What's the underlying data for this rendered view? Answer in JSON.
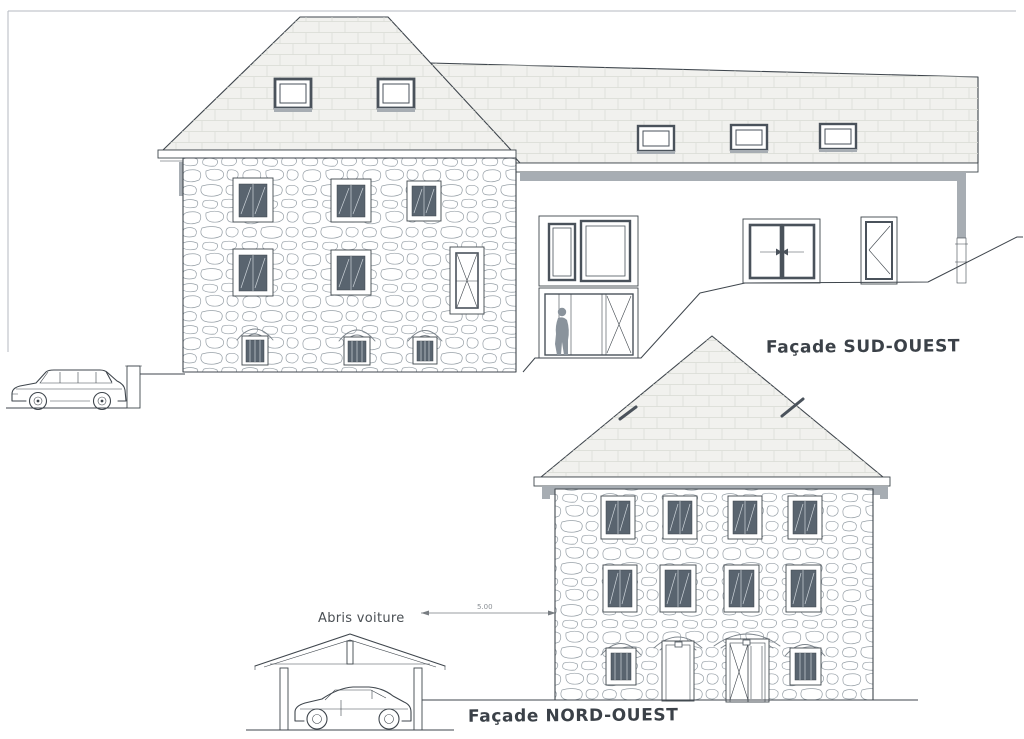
{
  "labels": {
    "facade_sud_ouest": "Façade SUD-OUEST",
    "facade_nord_ouest": "Façade NORD-OUEST",
    "abris_voiture": "Abris voiture",
    "dimension_value": "5.00"
  },
  "colors": {
    "paper": "#ffffff",
    "ink": "#3f464d",
    "roof_fill": "#f1f1ee",
    "gutter": "#a7adb3",
    "shutter": "#59646f",
    "frame": "#4a525b",
    "silhouette": "#8a939c",
    "label_ink": "#3b4148"
  }
}
